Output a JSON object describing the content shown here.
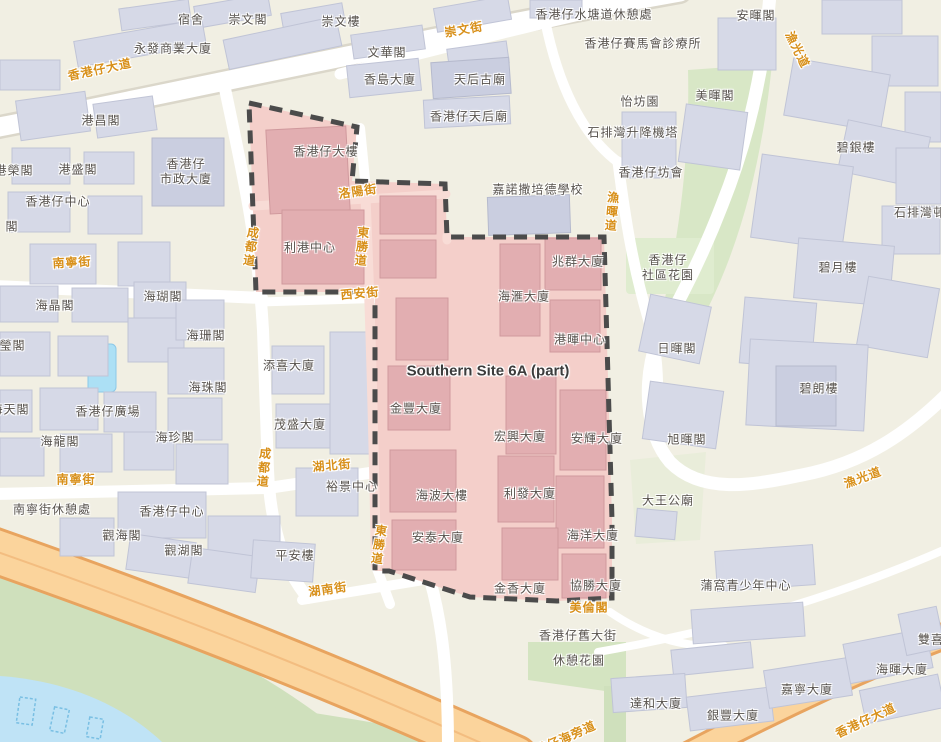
{
  "map": {
    "site_label": "Southern Site 6A (part)",
    "colors": {
      "land": "#f1efe3",
      "building_fill": "#d6d9e7",
      "green": "#cfe0bc",
      "water": "#bfe3f6",
      "highway": "#fbd49c",
      "site_fill": "#f4cfca",
      "site_building": "#e2aeb1",
      "site_boundary": "#4b4b4b",
      "street_label": "#d8901a",
      "building_label": "#57524d"
    },
    "labels": [
      {
        "t": "宿舍",
        "x": 191,
        "y": 20,
        "k": "b"
      },
      {
        "t": "崇文閣",
        "x": 248,
        "y": 20,
        "k": "b"
      },
      {
        "t": "崇文樓",
        "x": 341,
        "y": 22,
        "k": "b"
      },
      {
        "t": "永發商業大廈",
        "x": 173,
        "y": 49,
        "k": "b"
      },
      {
        "t": "文華閣",
        "x": 387,
        "y": 53,
        "k": "b"
      },
      {
        "t": "香島大廈",
        "x": 390,
        "y": 80,
        "k": "b"
      },
      {
        "t": "天后古廟",
        "x": 480,
        "y": 80,
        "k": "b"
      },
      {
        "t": "香港仔天后廟",
        "x": 469,
        "y": 117,
        "k": "b"
      },
      {
        "t": "香港仔水塘道休憩處",
        "x": 594,
        "y": 15,
        "k": "b"
      },
      {
        "t": "香港仔賽馬會診療所",
        "x": 643,
        "y": 44,
        "k": "b"
      },
      {
        "t": "安暉閣",
        "x": 756,
        "y": 16,
        "k": "b"
      },
      {
        "t": "怡坊園",
        "x": 640,
        "y": 102,
        "k": "b"
      },
      {
        "t": "美暉閣",
        "x": 715,
        "y": 96,
        "k": "b"
      },
      {
        "t": "石排灣升降機塔",
        "x": 633,
        "y": 133,
        "k": "b"
      },
      {
        "t": "碧銀樓",
        "x": 856,
        "y": 148,
        "k": "b"
      },
      {
        "t": "石排灣邨",
        "x": 920,
        "y": 213,
        "k": "b"
      },
      {
        "t": "港昌閣",
        "x": 101,
        "y": 121,
        "k": "b"
      },
      {
        "t": "港榮閣",
        "x": 14,
        "y": 171,
        "k": "b"
      },
      {
        "t": "港盛閣",
        "x": 78,
        "y": 170,
        "k": "b"
      },
      {
        "t": "香港仔中心",
        "x": 58,
        "y": 202,
        "k": "b"
      },
      {
        "t": "閣",
        "x": 12,
        "y": 227,
        "k": "b"
      },
      {
        "lines": [
          "香港仔",
          "市政大廈"
        ],
        "x": 186,
        "y": 172,
        "k": "b"
      },
      {
        "t": "海晶閣",
        "x": 55,
        "y": 306,
        "k": "b"
      },
      {
        "t": "海瑚閣",
        "x": 163,
        "y": 297,
        "k": "b"
      },
      {
        "t": "海珊閣",
        "x": 206,
        "y": 336,
        "k": "b"
      },
      {
        "t": "海珠閣",
        "x": 208,
        "y": 388,
        "k": "b"
      },
      {
        "t": "海瑩閣",
        "x": 6,
        "y": 346,
        "k": "b"
      },
      {
        "t": "海天閣",
        "x": 10,
        "y": 410,
        "k": "b"
      },
      {
        "t": "香港仔廣場",
        "x": 108,
        "y": 412,
        "k": "b"
      },
      {
        "t": "海龍閣",
        "x": 60,
        "y": 442,
        "k": "b"
      },
      {
        "t": "海珍閣",
        "x": 175,
        "y": 438,
        "k": "b"
      },
      {
        "t": "添喜大廈",
        "x": 289,
        "y": 366,
        "k": "b"
      },
      {
        "t": "茂盛大廈",
        "x": 300,
        "y": 425,
        "k": "b"
      },
      {
        "t": "裕景中心",
        "x": 352,
        "y": 487,
        "k": "b"
      },
      {
        "t": "南寧街休憩處",
        "x": 52,
        "y": 510,
        "k": "b"
      },
      {
        "t": "香港仔中心",
        "x": 172,
        "y": 512,
        "k": "b"
      },
      {
        "t": "觀海閣",
        "x": 122,
        "y": 536,
        "k": "b"
      },
      {
        "t": "觀湖閣",
        "x": 184,
        "y": 551,
        "k": "b"
      },
      {
        "t": "平安樓",
        "x": 295,
        "y": 556,
        "k": "b"
      },
      {
        "t": "嘉諾撒培德學校",
        "x": 538,
        "y": 190,
        "k": "b"
      },
      {
        "t": "香港仔坊會",
        "x": 651,
        "y": 173,
        "k": "b"
      },
      {
        "lines": [
          "香港仔",
          "社區花園"
        ],
        "x": 668,
        "y": 268,
        "k": "b"
      },
      {
        "t": "日暉閣",
        "x": 677,
        "y": 349,
        "k": "b"
      },
      {
        "t": "碧月樓",
        "x": 838,
        "y": 268,
        "k": "b"
      },
      {
        "t": "碧朗樓",
        "x": 819,
        "y": 389,
        "k": "b"
      },
      {
        "t": "旭暉閣",
        "x": 687,
        "y": 440,
        "k": "b"
      },
      {
        "t": "大王公廟",
        "x": 668,
        "y": 501,
        "k": "b"
      },
      {
        "t": "蒲窩青少年中心",
        "x": 746,
        "y": 586,
        "k": "b"
      },
      {
        "t": "達和大廈",
        "x": 656,
        "y": 704,
        "k": "b"
      },
      {
        "t": "銀豐大廈",
        "x": 733,
        "y": 716,
        "k": "b"
      },
      {
        "t": "嘉寧大廈",
        "x": 807,
        "y": 690,
        "k": "b"
      },
      {
        "t": "海暉大廈",
        "x": 902,
        "y": 670,
        "k": "b"
      },
      {
        "t": "雙喜",
        "x": 931,
        "y": 640,
        "k": "b"
      },
      {
        "t": "香港仔舊大街",
        "x": 578,
        "y": 636,
        "k": "b"
      },
      {
        "t": "休憩花園",
        "x": 579,
        "y": 661,
        "k": "b"
      },
      {
        "t": "香港仔大樓",
        "x": 326,
        "y": 152,
        "k": "b"
      },
      {
        "t": "利港中心",
        "x": 310,
        "y": 248,
        "k": "b"
      },
      {
        "t": "兆群大廈",
        "x": 578,
        "y": 262,
        "k": "b"
      },
      {
        "t": "海滙大廈",
        "x": 524,
        "y": 297,
        "k": "b"
      },
      {
        "t": "港暉中心",
        "x": 580,
        "y": 340,
        "k": "b"
      },
      {
        "t": "金豐大廈",
        "x": 416,
        "y": 409,
        "k": "b"
      },
      {
        "t": "宏興大廈",
        "x": 520,
        "y": 437,
        "k": "b"
      },
      {
        "t": "安輝大廈",
        "x": 597,
        "y": 439,
        "k": "b"
      },
      {
        "t": "海波大樓",
        "x": 442,
        "y": 496,
        "k": "b"
      },
      {
        "t": "利發大廈",
        "x": 530,
        "y": 494,
        "k": "b"
      },
      {
        "t": "安泰大廈",
        "x": 438,
        "y": 538,
        "k": "b"
      },
      {
        "t": "海洋大廈",
        "x": 593,
        "y": 536,
        "k": "b"
      },
      {
        "t": "金香大廈",
        "x": 520,
        "y": 589,
        "k": "b"
      },
      {
        "t": "協勝大廈",
        "x": 596,
        "y": 586,
        "k": "b"
      },
      {
        "t": "香港仔大道",
        "x": 100,
        "y": 70,
        "k": "s",
        "r": -12
      },
      {
        "t": "崇文街",
        "x": 464,
        "y": 30,
        "k": "s",
        "r": -10
      },
      {
        "t": "漁光道",
        "x": 797,
        "y": 50,
        "k": "s",
        "r": 64
      },
      {
        "t": "南寧街",
        "x": 72,
        "y": 263,
        "k": "s",
        "r": -3
      },
      {
        "t": "洛陽街",
        "x": 358,
        "y": 192,
        "k": "s",
        "r": -8
      },
      {
        "t": "西安街",
        "x": 360,
        "y": 294,
        "k": "s",
        "r": -5
      },
      {
        "t": "南寧街",
        "x": 76,
        "y": 480,
        "k": "s",
        "r": 0
      },
      {
        "t": "湖北街",
        "x": 332,
        "y": 466,
        "k": "s",
        "r": -5
      },
      {
        "t": "湖南街",
        "x": 328,
        "y": 590,
        "k": "s",
        "r": -8
      },
      {
        "t": "美倫閣",
        "x": 589,
        "y": 608,
        "k": "s",
        "r": 0
      },
      {
        "t": "漁光道",
        "x": 863,
        "y": 478,
        "k": "s",
        "r": -20
      },
      {
        "t": "香港仔大道",
        "x": 866,
        "y": 721,
        "k": "s",
        "r": -25
      },
      {
        "t": "香港仔海旁道",
        "x": 560,
        "y": 741,
        "k": "s",
        "r": -24
      },
      {
        "t": "成都道",
        "x": 250,
        "y": 247,
        "k": "sv",
        "r": 8
      },
      {
        "t": "成都道",
        "x": 263,
        "y": 468,
        "k": "sv",
        "r": 5
      },
      {
        "t": "東勝道",
        "x": 361,
        "y": 247,
        "k": "sv",
        "r": 5
      },
      {
        "t": "東勝道",
        "x": 378,
        "y": 545,
        "k": "sv",
        "r": 8
      },
      {
        "t": "漁暉道",
        "x": 611,
        "y": 212,
        "k": "sv",
        "r": 5
      },
      {
        "t": "Southern Site 6A (part)",
        "x": 488,
        "y": 372,
        "k": "site"
      }
    ]
  }
}
